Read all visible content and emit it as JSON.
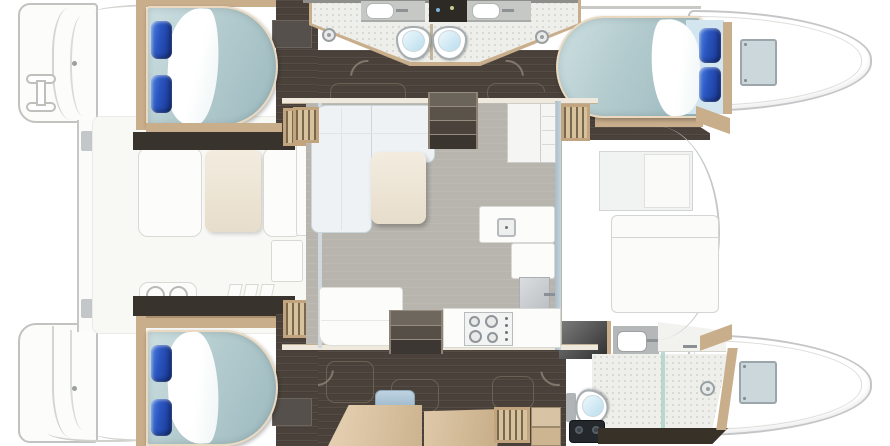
{
  "meta": {
    "type": "yacht floor plan",
    "subject": "catamaran sailing yacht, top-down interior layout",
    "orientation": "bows pointing right, sterns left",
    "cabins": 3,
    "bathrooms": 3
  },
  "palette": {
    "background": "#ffffff",
    "hull_outline": "#c3c5c7",
    "dark_floor": "#4a423a",
    "dark_wall": "#39332d",
    "wood_trim": "#c9ae8c",
    "mattress": "#b3cbce",
    "pillow_blue": "#2a55c0",
    "tile": "#eeeeea",
    "salon_floor": "#b8b5ae",
    "table_wood": "#efe7da",
    "desk_wood": "#d9c3a8",
    "toilet_bowl": "#cfe8f6",
    "appliance_black": "#24282d"
  },
  "regions": {
    "port_hull": {
      "label": "Port hull (top)",
      "aft_cabin": {
        "label": "Port aft cabin with double berth",
        "pillows": 2,
        "sheet": "white fold",
        "steps": "slatted companionway"
      },
      "heads": {
        "label": "Twin bathrooms amidships",
        "toilets": 2,
        "sinks": 2,
        "shower_drains": 2,
        "niche": "dark vanity niche"
      },
      "forward_cabin": {
        "label": "Port forward cabin with double berth",
        "pillows": 2
      },
      "bow": {
        "label": "Port bow with deck hatch",
        "hatch": 1
      }
    },
    "starboard_hull": {
      "label": "Starboard hull (bottom, owner suite)",
      "aft_cabin": {
        "label": "Starboard aft cabin with double berth",
        "pillows": 2
      },
      "lounge": {
        "label": "Owner lounge with desk, seat cushion and floor hatches",
        "floor_hatches": 3,
        "cushion": 1,
        "steps": "wood steps + slatted grate"
      },
      "forward_head": {
        "label": "Owner bathroom with shower, toilet, sink, mirror and appliance",
        "toilet": 1,
        "sink": 1,
        "drain": 1,
        "appliance": "black unit with two dials"
      },
      "bow": {
        "label": "Starboard bow with deck hatch",
        "hatch": 1
      }
    },
    "bridgedeck": {
      "salon": {
        "label": "Salon on bridgedeck",
        "sofa": "L-shaped sofa",
        "table": "coffee table",
        "fridge": "cabinet with shelves",
        "steps_down": 2
      },
      "galley": {
        "label": "Galley",
        "sink": 1,
        "stove_burners": 4,
        "locker_door": "grey panel with handle"
      },
      "cockpit": {
        "label": "Aft cockpit",
        "dining_table": 1,
        "benches": 2,
        "grill": "wet bar with two wells",
        "side_table": 1,
        "step_tabs": 3
      },
      "foredeck": {
        "label": "Forward deck lounge",
        "window_recess": 1,
        "sunpad": 1
      },
      "stern": {
        "label": "Stern platforms",
        "swim_ladder": 1,
        "cleats": 2,
        "crossbeam_clips": 2
      }
    }
  }
}
